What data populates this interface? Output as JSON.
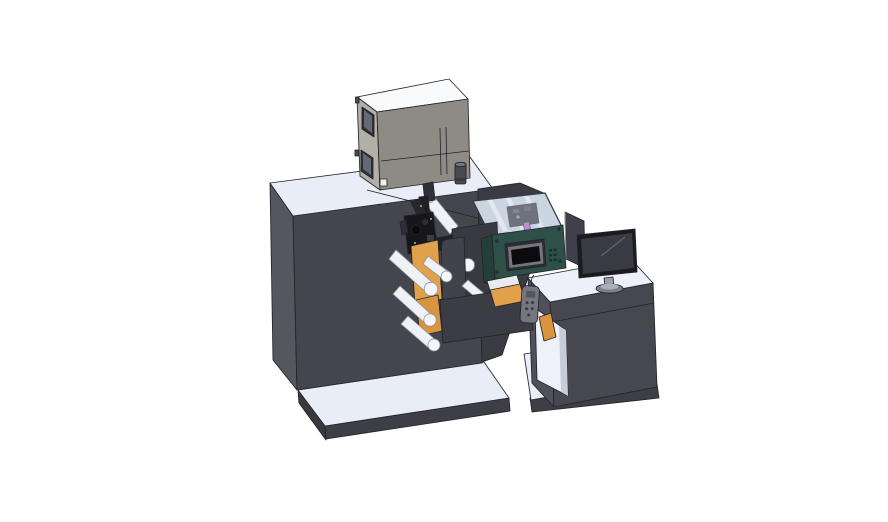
{
  "scene": {
    "type": "3d-cad-render",
    "description": "Isometric CAD rendering of a compact label printing press line: main press cabinet with electrical box on top, orange unwind roll with white web guide rollers, print head under a transparent cover, teal HMI control panel with touchscreen, hand-held pendant, and an operator desk with a monitor",
    "background": "#ffffff"
  },
  "colors": {
    "outline": "#23232a",
    "machine_front": "#45454e",
    "machine_side": "#56565f",
    "surface_light": "#e9edf8",
    "base_dark": "#3e3e46",
    "base_side": "#38383f",
    "cabinet_top": "#f9fafb",
    "cabinet_side": "#b2afa7",
    "cabinet_front": "#8e8b84",
    "window_frame": "#2f2f36",
    "window_glass": "#636a76",
    "vent_cylinder": "#4a4a52",
    "back_wall": "#3a3a42",
    "plate_front": "#42424b",
    "plate_back": "#393942",
    "roll_orange": "#e2a04a",
    "roll_orange_dark": "#d8943e",
    "roll_orange_shadow": "#c9883a",
    "roller_white": "#eff1f5",
    "roller_cap": "#f4f5f8",
    "mech_black": "#17171b",
    "mech_dark": "#26262b",
    "mech_gray": "#3c3c44",
    "panel_teal": "#2f5049",
    "panel_teal_dark": "#223f39",
    "hmi_bezel": "#2c2c33",
    "hmi_frame": "#757580",
    "hmi_screen": "#0c0c0f",
    "carriage_purple": "#b356c3",
    "carriage_dark": "#28282d",
    "cover_interior": "#c9d0db",
    "cover_glass": "rgba(208,216,234,0.42)",
    "arm_dark": "#3c3c45",
    "pendant_gray": "#75757e",
    "desk_front": "#474750",
    "desk_side": "#50505a",
    "desk_top": "#edf0f9",
    "opening_interior": "#eff1f8",
    "opening_wall": "#c7ccd9",
    "monitor_bezel": "#1a1a1f",
    "monitor_screen": "#3a3a43",
    "monitor_stand": "#9aa0aa",
    "monitor_base": "#7b808a",
    "shield_panel": "#40404a",
    "latch_white": "#eeeef0",
    "strip_white": "#e9ebf1"
  },
  "components": {
    "machine_body": "main press cabinet",
    "electrical_cabinet": "electrical box on machine top",
    "vent": "cylindrical vent filter",
    "unwind_roll": "orange unwind roll",
    "web_rollers": "white web guide rollers",
    "print_head": "print head mechanism",
    "safety_cover": "transparent safety cover with carriage",
    "hmi_panel": "teal control panel with touchscreen",
    "cover_plates": "front cover plates",
    "outfeed_arm": "out-feed arm with label trays",
    "pendant": "hand-held pendant control",
    "operator_desk": "operator desk cabinet",
    "monitor": "desk monitor",
    "side_screen": "side display panel"
  }
}
